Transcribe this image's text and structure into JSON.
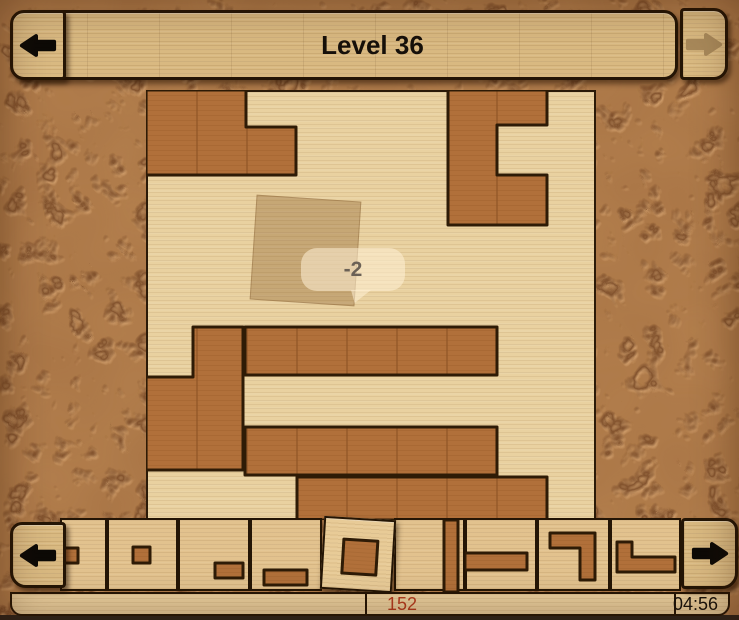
{
  "header": {
    "title": "Level 36",
    "prev_icon": "left-arrow",
    "next_icon": "right-arrow-disabled"
  },
  "tooltip": {
    "text": "-2"
  },
  "status": {
    "moves": "152",
    "time": "04:56"
  },
  "tray_nav": {
    "left_icon": "left-arrow",
    "right_icon": "right-arrow"
  },
  "colors": {
    "piece_wood": "#b1703a",
    "piece_border": "#2e1b06",
    "board_wood": "#e9d1a0",
    "panel_wood": "#d9b981",
    "tile_wood": "#e2c28e",
    "ground_clay": "#b6824f",
    "crack_line": "#7d4e2b",
    "score_text": "#b23b1e",
    "time_text": "#17120c",
    "disabled_arrow": "#a8895a",
    "enabled_arrow": "#0d0a06"
  },
  "board": {
    "blocks": [
      {
        "points": "0,0 100,0 100,37 150,37 150,85 0,85"
      },
      {
        "points": "302,0 401,0 401,35 351,35 351,85 401,85 401,135 302,135"
      },
      {
        "points": "47,237 97,237 97,380 0,380 0,287 47,287"
      },
      {
        "points": "99,237 351,237 351,285 99,285"
      },
      {
        "points": "99,337 351,337 351,385 99,385"
      },
      {
        "points": "151,387 401,387 401,430 151,430"
      }
    ],
    "ghost": {
      "x": 105,
      "y": 106,
      "size": 103,
      "rotation": 3.8
    }
  },
  "tray": {
    "tiles": [
      {
        "x": 60,
        "w": 47,
        "pieces": [
          "2,28 18,28 18,43 2,43"
        ]
      },
      {
        "x": 107,
        "w": 71,
        "pieces": [
          "26,27 43,27 43,43 26,43"
        ]
      },
      {
        "x": 178,
        "w": 72,
        "pieces": [
          "37,43 65,43 65,58 37,58"
        ]
      },
      {
        "x": 250,
        "w": 72,
        "pieces": [
          "14,50 57,50 57,65 14,65"
        ]
      },
      {
        "x": 322,
        "w": 72,
        "rotated": 3.5,
        "selected": true,
        "pieces": [
          "21,20 55,20 55,54 21,54"
        ]
      },
      {
        "x": 394,
        "w": 71,
        "pieces": [
          "50,0 64,0 64,72 50,72"
        ]
      },
      {
        "x": 465,
        "w": 72,
        "pieces": [
          "0,33 62,33 62,50 0,50"
        ]
      },
      {
        "x": 537,
        "w": 73,
        "pieces": [
          "13,13 58,13 58,60 43,60 43,28 13,28"
        ]
      },
      {
        "x": 610,
        "w": 71,
        "pieces": [
          "7,22 22,22 22,37 65,37 65,52 7,52"
        ]
      }
    ]
  }
}
